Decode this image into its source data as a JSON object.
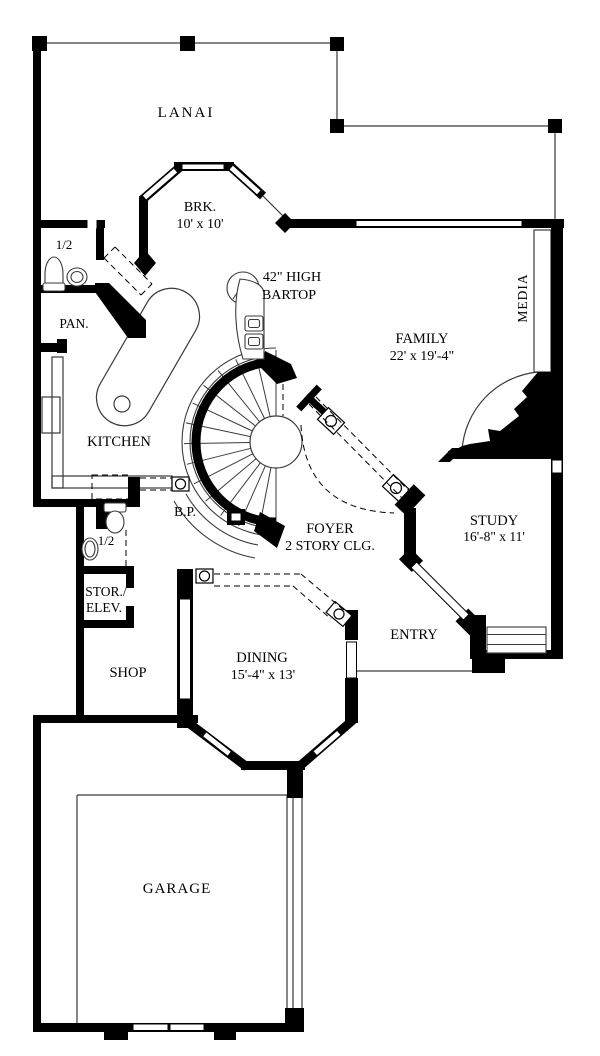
{
  "plan": {
    "title": "Residential first-floor plan",
    "rooms": {
      "lanai": {
        "label": "LANAI"
      },
      "breakfast": {
        "label": "BRK.",
        "dims": "10' x 10'"
      },
      "bartop": {
        "line1": "42\" HIGH",
        "line2": "BARTOP"
      },
      "powder_upper": {
        "label": "1/2"
      },
      "pantry": {
        "label": "PAN."
      },
      "media": {
        "label": "MEDIA"
      },
      "family": {
        "label": "FAMILY",
        "dims": "22' x 19'-4\""
      },
      "kitchen": {
        "label": "KITCHEN"
      },
      "butlers_pantry": {
        "label": "B.P."
      },
      "powder_lower": {
        "label": "1/2"
      },
      "foyer": {
        "label": "FOYER",
        "note": "2 STORY CLG."
      },
      "study": {
        "label": "STUDY",
        "dims": "16'-8\" x 11'"
      },
      "storage_elev": {
        "line1": "STOR./",
        "line2": "ELEV."
      },
      "entry": {
        "label": "ENTRY"
      },
      "dining": {
        "label": "DINING",
        "dims": "15'-4\" x 13'"
      },
      "shop": {
        "label": "SHOP"
      },
      "garage": {
        "label": "GARAGE"
      }
    },
    "colors": {
      "wall": "#000000",
      "paper": "#ffffff",
      "thin_line": "#3a3a3a"
    }
  }
}
